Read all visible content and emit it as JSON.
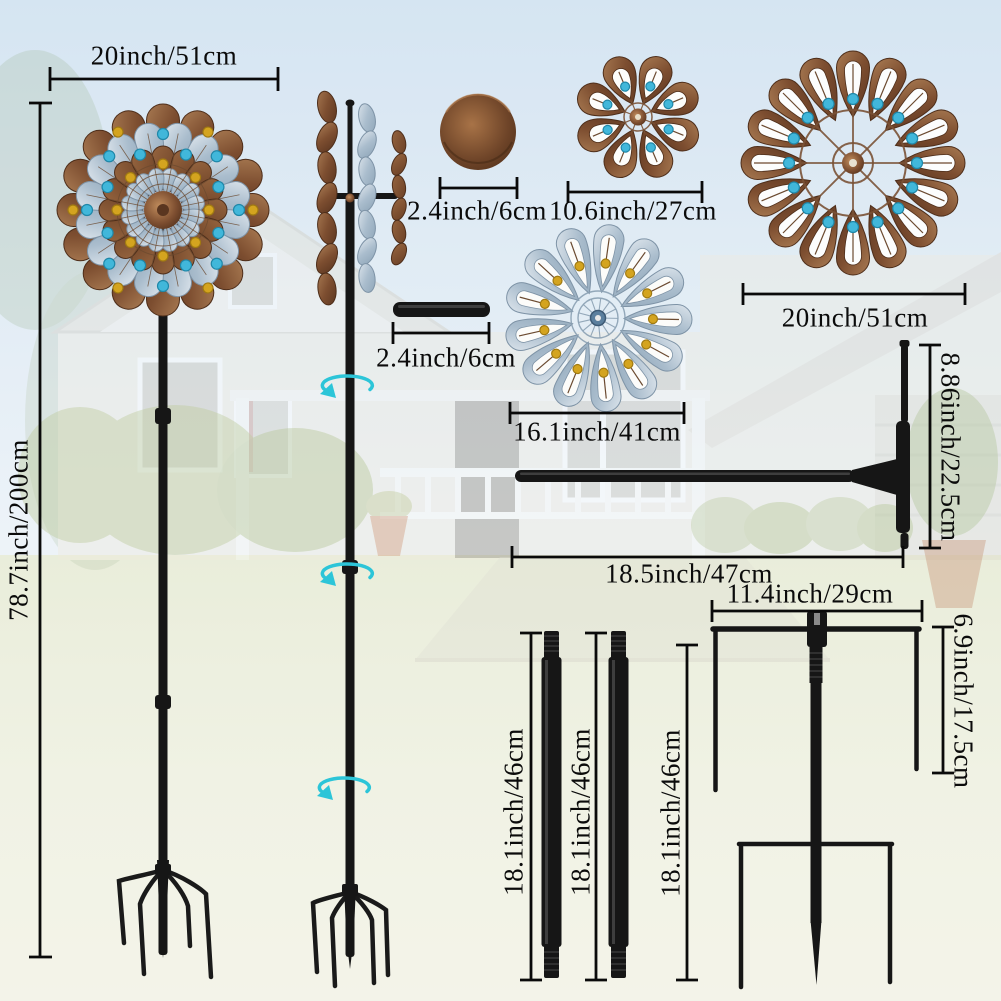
{
  "title": "Wind spinner product dimensions diagram",
  "dimensions": {
    "head_width": "20inch/51cm",
    "total_height": "78.7inch/200cm",
    "cap_diameter": "2.4inch/6cm",
    "small_flower_diameter": "10.6inch/27cm",
    "large_spinner_diameter": "20inch/51cm",
    "connector_tube_length": "2.4inch/6cm",
    "blue_spinner_diameter": "16.1inch/41cm",
    "t_rod_height": "8.86inch/22.5cm",
    "t_rod_length": "18.5inch/47cm",
    "stake_width": "11.4inch/29cm",
    "stake_fork_height": "6.9inch/17.5cm",
    "pole_section_a_length": "18.1inch/46cm",
    "pole_section_b_length": "18.1inch/46cm",
    "stake_spike_length": "18.1inch/46cm"
  },
  "icons": {
    "rotation_arrow": "↻"
  },
  "colors": {
    "copper": "#7d4e30",
    "silver_blue": "#aabdcd",
    "bead_blue": "#41b7da",
    "bead_amber": "#d4a41f",
    "metal_black": "#161616",
    "rotation_arrow": "#2cc5d8",
    "dimension_line": "#0a0a0a",
    "sky": "#cfe1f0",
    "lawn": "#e9eed9"
  }
}
